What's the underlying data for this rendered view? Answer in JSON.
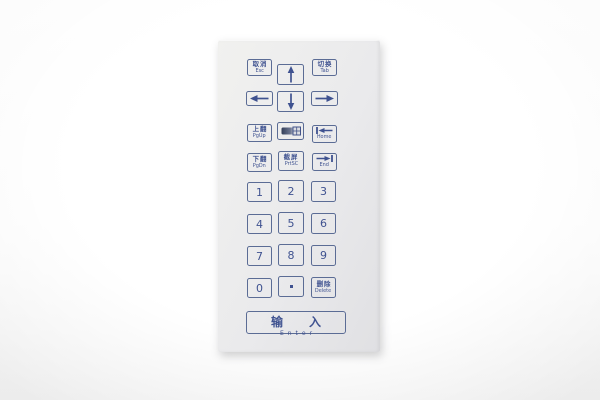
{
  "keypad": {
    "colors": {
      "ink": "#3f5290",
      "key_border": "#5b6c95",
      "panel_bg": "#eaeaec",
      "backdrop": "#f6f6f6"
    },
    "keys": {
      "esc": {
        "zh": "取消",
        "en": "Esc"
      },
      "up": {
        "icon": "up-arrow"
      },
      "tab": {
        "zh": "切换",
        "en": "Tab"
      },
      "left": {
        "icon": "left-arrow"
      },
      "down": {
        "icon": "down-arrow"
      },
      "right": {
        "icon": "right-arrow"
      },
      "pgup": {
        "zh": "上翻",
        "en": "PgUp"
      },
      "backlight": {
        "icon": "backlight-grid"
      },
      "home": {
        "icon": "bar-left-arrow",
        "en": "Home"
      },
      "pgdn": {
        "zh": "下翻",
        "en": "PgDn"
      },
      "prtsc": {
        "zh": "截屏",
        "en": "PrtSC"
      },
      "end": {
        "icon": "right-arrow-bar",
        "en": "End"
      },
      "d1": {
        "label": "1"
      },
      "d2": {
        "label": "2"
      },
      "d3": {
        "label": "3"
      },
      "d4": {
        "label": "4"
      },
      "d5": {
        "label": "5"
      },
      "d6": {
        "label": "6"
      },
      "d7": {
        "label": "7"
      },
      "d8": {
        "label": "8"
      },
      "d9": {
        "label": "9"
      },
      "d0": {
        "label": "0"
      },
      "dot": {
        "icon": "square-dot"
      },
      "delete": {
        "zh": "删除",
        "en": "Delete"
      },
      "enter": {
        "zh": "输入",
        "en": "Enter"
      }
    }
  }
}
